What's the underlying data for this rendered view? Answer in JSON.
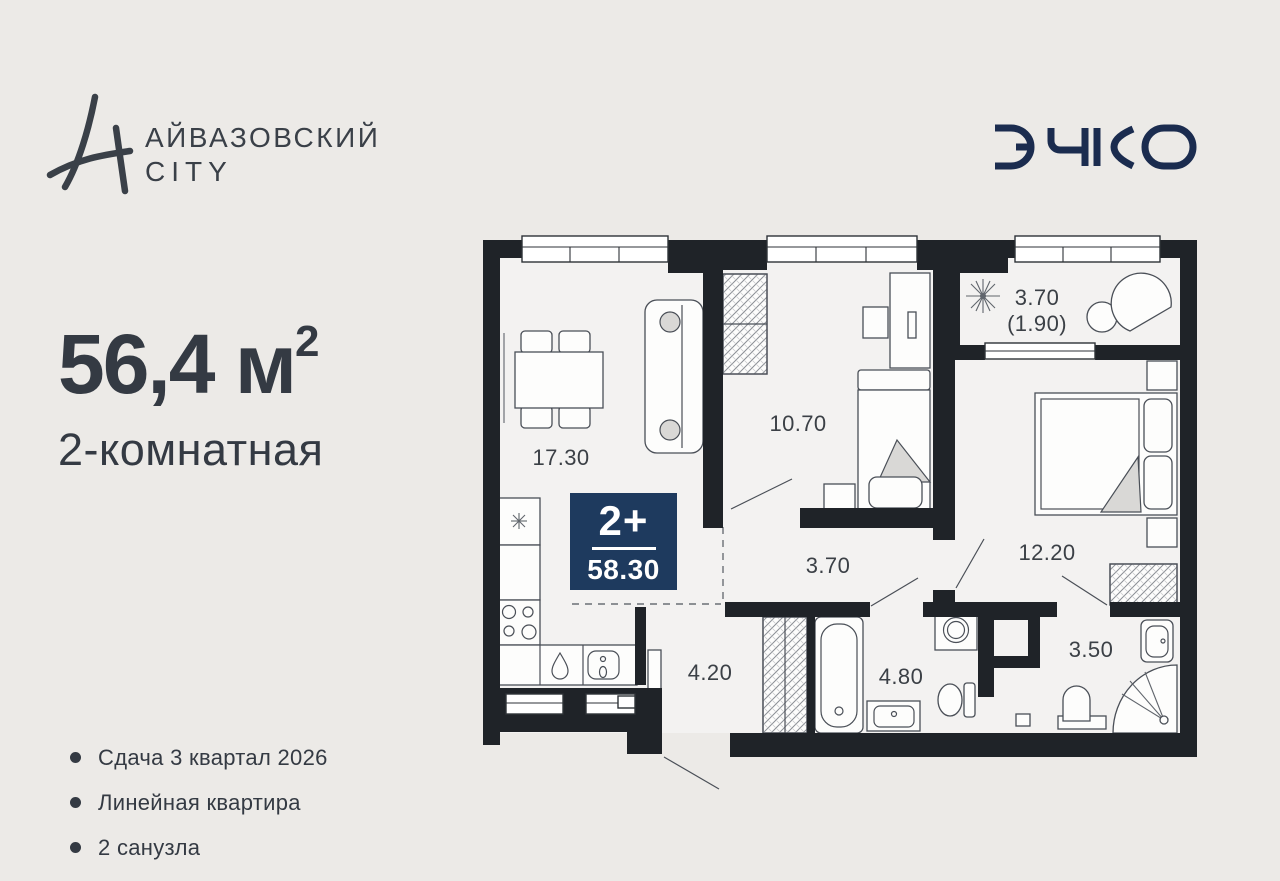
{
  "colors": {
    "background": "#ECEAE7",
    "ink": "#3A4048",
    "wall": "#1F2328",
    "floor": "#F3F2F1",
    "badge_bg": "#1E3A5E",
    "logo_navy": "#1B2C4F"
  },
  "header": {
    "brand_line1": "АЙВАЗОВСКИЙ",
    "brand_line2": "CITY",
    "developer_name": "ЭНКО"
  },
  "apartment": {
    "area_display": "56,4 м",
    "area_sup": "2",
    "type_label": "2-комнатная"
  },
  "features": [
    "Сдача 3 квартал 2026",
    "Линейная квартира",
    "2 санузла"
  ],
  "plan": {
    "badge": {
      "rooms": "2+",
      "total_area": "58.30"
    },
    "rooms": [
      {
        "id": "living-kitchen",
        "area": "17.30"
      },
      {
        "id": "bedroom-1",
        "area": "10.70"
      },
      {
        "id": "balcony",
        "area": "3.70",
        "area_secondary": "(1.90)"
      },
      {
        "id": "bedroom-2",
        "area": "12.20"
      },
      {
        "id": "hall",
        "area": "3.70"
      },
      {
        "id": "hallway",
        "area": "4.20"
      },
      {
        "id": "bathroom-1",
        "area": "4.80"
      },
      {
        "id": "bathroom-2",
        "area": "3.50"
      }
    ]
  }
}
